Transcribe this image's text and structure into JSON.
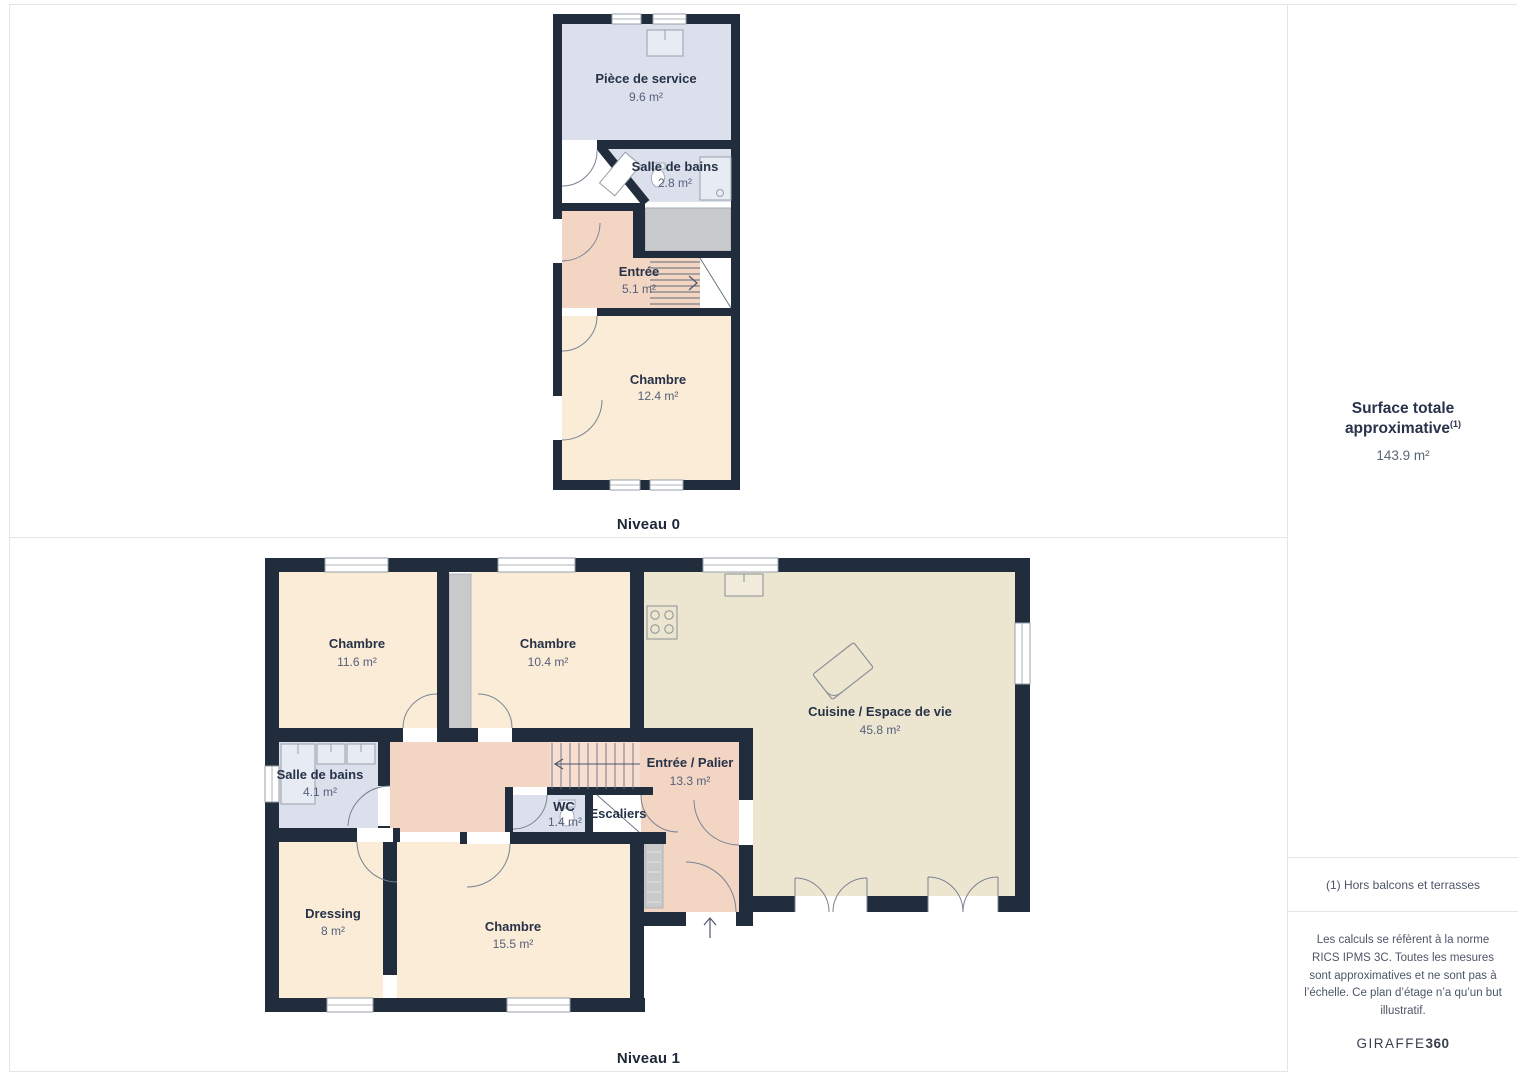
{
  "palette": {
    "wall": "#212d3d",
    "floor_blue": "#dbe0ec",
    "floor_cream": "#faecd7",
    "floor_salmon": "#f3d5c4",
    "floor_beige": "#ece6d1",
    "shaft_gray": "#c9cacc",
    "border_gray": "#e3e5e7"
  },
  "levels": [
    {
      "label": "Niveau 0",
      "rooms": [
        {
          "name": "Pièce de service",
          "area": "9.6 m²"
        },
        {
          "name": "Salle de bains",
          "area": "2.8 m²"
        },
        {
          "name": "Entrée",
          "area": "5.1 m²"
        },
        {
          "name": "Chambre",
          "area": "12.4 m²"
        }
      ]
    },
    {
      "label": "Niveau 1",
      "rooms": [
        {
          "name": "Chambre",
          "area": "11.6 m²"
        },
        {
          "name": "Chambre",
          "area": "10.4 m²"
        },
        {
          "name": "Cuisine / Espace de vie",
          "area": "45.8 m²"
        },
        {
          "name": "Salle de bains",
          "area": "4.1 m²"
        },
        {
          "name": "Entrée / Palier",
          "area": "13.3 m²"
        },
        {
          "name": "WC",
          "area": "1.4 m²"
        },
        {
          "name": "Escaliers",
          "area": ""
        },
        {
          "name": "Dressing",
          "area": "8 m²"
        },
        {
          "name": "Chambre",
          "area": "15.5 m²"
        }
      ]
    }
  ],
  "sidebar": {
    "title": "Surface totale approximative",
    "title_superscript": "(1)",
    "total_area": "143.9 m²",
    "footnote": "(1) Hors balcons et terrasses",
    "disclaimer": "Les calculs se réfèrent à la norme RICS IPMS 3C. Toutes les mesures sont approximatives et ne sont pas à l’échelle. Ce plan d’étage n’a qu’un but illustratif.",
    "brand_name": "GIRAFFE",
    "brand_suffix": "360"
  }
}
